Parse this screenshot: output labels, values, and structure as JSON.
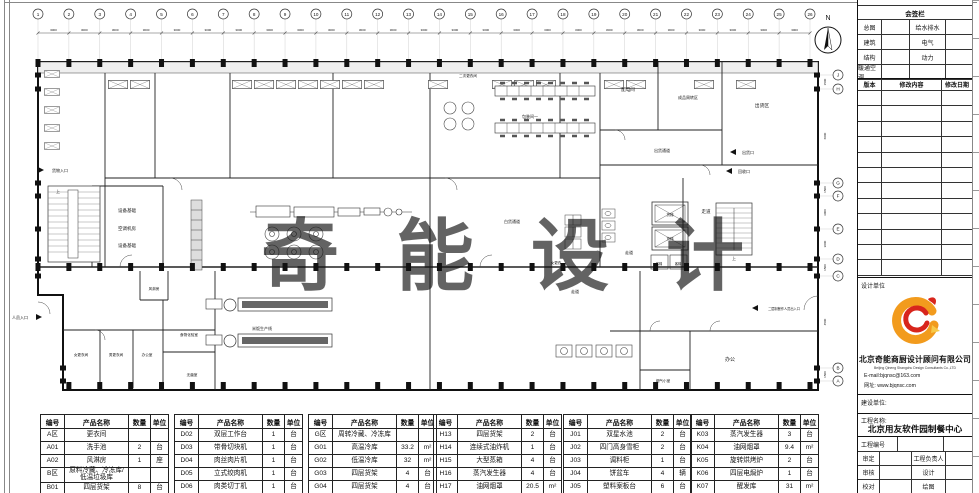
{
  "plan": {
    "north_label": "N",
    "watermark": "奇能设计",
    "grid": {
      "cols": [
        "1",
        "2",
        "3",
        "4",
        "5",
        "6",
        "7",
        "8",
        "9",
        "10",
        "11",
        "12",
        "13",
        "14",
        "15",
        "16",
        "17",
        "18",
        "19",
        "20",
        "21",
        "22",
        "23",
        "24",
        "25",
        "26"
      ],
      "col_dim": "3000",
      "rows": [
        {
          "label": "J",
          "y": 75
        },
        {
          "label": "H",
          "y": 89
        },
        {
          "label": "G",
          "y": 183
        },
        {
          "label": "F",
          "y": 196
        },
        {
          "label": "E",
          "y": 229
        },
        {
          "label": "D",
          "y": 259
        },
        {
          "label": "C",
          "y": 276
        },
        {
          "label": "B",
          "y": 368
        },
        {
          "label": "A",
          "y": 381
        }
      ],
      "row_dims": [
        "1500",
        "6000",
        "1500",
        "3000",
        "3000",
        "1500",
        "4500",
        "1500"
      ]
    },
    "rooms": [
      {
        "label": "N",
        "x": 828,
        "y": 20,
        "fs": 7
      },
      {
        "label": "设备基础",
        "x": 127,
        "y": 212
      },
      {
        "label": "空调机房",
        "x": 127,
        "y": 230
      },
      {
        "label": "设备基础",
        "x": 127,
        "y": 247
      },
      {
        "label": "货物入口",
        "x": 60,
        "y": 172,
        "fs": 4
      },
      {
        "label": "人员入口",
        "x": 20,
        "y": 319,
        "fs": 4
      },
      {
        "label": "风淋房",
        "x": 154,
        "y": 290,
        "fs": 3.6
      },
      {
        "label": "女更衣间",
        "x": 81,
        "y": 356,
        "fs": 3.6
      },
      {
        "label": "男更衣间",
        "x": 116,
        "y": 356,
        "fs": 3.6
      },
      {
        "label": "办公室",
        "x": 147,
        "y": 356,
        "fs": 3.6
      },
      {
        "label": "食物化验室",
        "x": 189,
        "y": 336,
        "fs": 3.6
      },
      {
        "label": "无菌室",
        "x": 192,
        "y": 376,
        "fs": 3.6
      },
      {
        "label": "米饭生产线",
        "x": 262,
        "y": 330,
        "fs": 4
      },
      {
        "label": "二次更衣间",
        "x": 468,
        "y": 77,
        "fs": 3.6
      },
      {
        "label": "包装间一",
        "x": 530,
        "y": 118,
        "fs": 4
      },
      {
        "label": "配电间",
        "x": 628,
        "y": 91,
        "fs": 4.5
      },
      {
        "label": "成品周转区",
        "x": 688,
        "y": 99,
        "fs": 4
      },
      {
        "label": "出货区",
        "x": 762,
        "y": 107,
        "fs": 4.8
      },
      {
        "label": "出货通道",
        "x": 662,
        "y": 152,
        "fs": 4
      },
      {
        "label": "出货口",
        "x": 748,
        "y": 154,
        "fs": 4
      },
      {
        "label": "回收口",
        "x": 744,
        "y": 173,
        "fs": 4
      },
      {
        "label": "白货通道",
        "x": 512,
        "y": 223,
        "fs": 4
      },
      {
        "label": "女更衣",
        "x": 556,
        "y": 264,
        "fs": 3.6
      },
      {
        "label": "走道",
        "x": 706,
        "y": 213,
        "fs": 4.5
      },
      {
        "label": "走道",
        "x": 629,
        "y": 254,
        "fs": 4
      },
      {
        "label": "走道",
        "x": 575,
        "y": 293,
        "fs": 4
      },
      {
        "label": "货梯",
        "x": 670,
        "y": 216,
        "fs": 3.6
      },
      {
        "label": "货梯",
        "x": 670,
        "y": 240,
        "fs": 3.6
      },
      {
        "label": "客梯",
        "x": 659,
        "y": 265,
        "fs": 3.2
      },
      {
        "label": "客梯",
        "x": 678,
        "y": 265,
        "fs": 3.2
      },
      {
        "label": "上",
        "x": 734,
        "y": 260,
        "fs": 4
      },
      {
        "label": "上",
        "x": 58,
        "y": 193,
        "fs": 4
      },
      {
        "label": "办公",
        "x": 730,
        "y": 361,
        "fs": 5
      },
      {
        "label": "烟气小室",
        "x": 663,
        "y": 382,
        "fs": 3.6
      },
      {
        "label": "二层制餐作人员出入口",
        "x": 784,
        "y": 310,
        "fs": 3.2
      }
    ]
  },
  "equipment_tables": {
    "headers": [
      "编号",
      "产品名称",
      "数量",
      "单位"
    ],
    "col_widths": [
      24,
      64,
      22,
      18
    ],
    "tables": [
      {
        "rows": [
          [
            "A区",
            "更衣间",
            "",
            ""
          ],
          [
            "A01",
            "洗手池",
            "2",
            "台"
          ],
          [
            "A02",
            "风淋房",
            "1",
            "座"
          ],
          [
            "B区",
            "原料冷藏、冷冻库/低温垃圾库",
            "",
            ""
          ],
          [
            "B01",
            "四层货架",
            "8",
            "台"
          ]
        ]
      },
      {
        "rows": [
          [
            "D02",
            "双层工作台",
            "1",
            "台"
          ],
          [
            "D03",
            "带骨切块机",
            "1",
            "台"
          ],
          [
            "D04",
            "肉丝肉片机",
            "1",
            "台"
          ],
          [
            "D05",
            "立式绞肉机",
            "1",
            "台"
          ],
          [
            "D06",
            "肉类切丁机",
            "1",
            "台"
          ],
          [
            "",
            "",
            "",
            ""
          ]
        ]
      },
      {
        "rows": [
          [
            "G区",
            "周转冷藏、冷冻库",
            "",
            ""
          ],
          [
            "G01",
            "高温冷库",
            "33.2",
            "m²"
          ],
          [
            "G02",
            "低温冷库",
            "32",
            "m²"
          ],
          [
            "G03",
            "四层货架",
            "4",
            "台"
          ],
          [
            "G04",
            "四层货架",
            "4",
            "台"
          ]
        ]
      },
      {
        "rows": [
          [
            "H13",
            "四层货架",
            "2",
            "台"
          ],
          [
            "H14",
            "连续式油炸机",
            "1",
            "台"
          ],
          [
            "H15",
            "大型蒸箱",
            "4",
            "台"
          ],
          [
            "H16",
            "蒸汽发生器",
            "4",
            "台"
          ],
          [
            "H17",
            "油网烟罩",
            "20.5",
            "m²"
          ],
          [
            "H18",
            "",
            "",
            ""
          ]
        ]
      },
      {
        "rows": [
          [
            "J01",
            "双星水池",
            "2",
            "台"
          ],
          [
            "J02",
            "四门高身雪柜",
            "2",
            "台"
          ],
          [
            "J03",
            "调料柜",
            "1",
            "台"
          ],
          [
            "J04",
            "饼盆车",
            "4",
            "辆"
          ],
          [
            "J05",
            "塑料案板台",
            "6",
            "台"
          ],
          [
            "J06",
            "面粉车",
            "10",
            "台"
          ]
        ]
      },
      {
        "rows": [
          [
            "K03",
            "蒸汽发生器",
            "3",
            "台"
          ],
          [
            "K04",
            "油网烟罩",
            "9.4",
            "m²"
          ],
          [
            "K05",
            "旋转烘烤炉",
            "2",
            "台"
          ],
          [
            "K06",
            "四层电焗炉",
            "1",
            "台"
          ],
          [
            "K07",
            "醒发库",
            "31",
            "m²"
          ],
          [
            "K08",
            "四层货架",
            "5",
            "台"
          ]
        ]
      }
    ]
  },
  "title_block": {
    "sign_panel": {
      "title": "会签栏",
      "rows": [
        [
          "总图",
          "给水排水"
        ],
        [
          "建筑",
          "电气"
        ],
        [
          "结构",
          "动力"
        ],
        [
          "暖通空调",
          ""
        ]
      ]
    },
    "revision": {
      "headers": [
        "版本",
        "修改内容",
        "修改日期"
      ],
      "empty_rows": 12
    },
    "design_unit_label": "设计单位",
    "company": {
      "name_cn": "北京奇能商厨设计顾问有限公司",
      "name_en": "Beijing Qineng Shangchu Design Consultants Co.,LTD",
      "email": "E-mail:bjqnsc@163.com",
      "website": "网址: www.bjqnsc.com"
    },
    "client_label": "建设单位:",
    "project_name_label": "工程名称:",
    "project_name": "北京用友软件园制餐中心",
    "project_no_label": "工程编号",
    "fields": [
      [
        "审定",
        "工程负责人"
      ],
      [
        "审核",
        "设计"
      ],
      [
        "校对",
        "绘图"
      ]
    ]
  },
  "colors": {
    "line": "#1a1a1a",
    "wall_fill": "#efefef",
    "watermark": "#d9d9d9",
    "logo_orange": "#F29B1D",
    "logo_red": "#D8251C",
    "logo_yellow": "#F7C948"
  }
}
